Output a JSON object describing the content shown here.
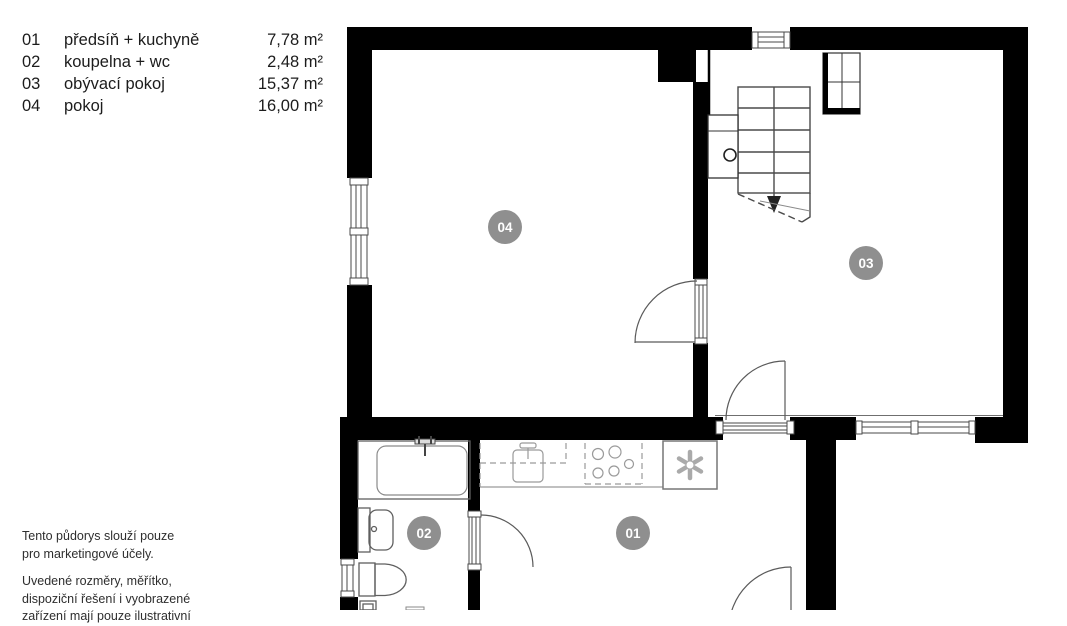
{
  "legend": {
    "rows": [
      {
        "num": "01",
        "label": "předsíň + kuchyně",
        "area": "7,78 m²"
      },
      {
        "num": "02",
        "label": "koupelna + wc",
        "area": "2,48 m²"
      },
      {
        "num": "03",
        "label": "obývací pokoj",
        "area": "15,37 m²"
      },
      {
        "num": "04",
        "label": "pokoj",
        "area": "16,00 m²"
      }
    ]
  },
  "disclaimer": {
    "line1": "Tento půdorys slouží pouze",
    "line2": "pro marketingové účely.",
    "line3": "Uvedené rozměry, měřítko,",
    "line4": "dispoziční řešení i vyobrazené",
    "line5": "zařízení mají pouze ilustrativní"
  },
  "plan": {
    "badges": [
      {
        "id": "01"
      },
      {
        "id": "02"
      },
      {
        "id": "03"
      },
      {
        "id": "04"
      }
    ],
    "colors": {
      "wall": "#000000",
      "badge": "#8f8f8f",
      "badge_text": "#ffffff",
      "fixture_line": "#9a9a9a",
      "plan_line": "#4a4a4a"
    }
  }
}
